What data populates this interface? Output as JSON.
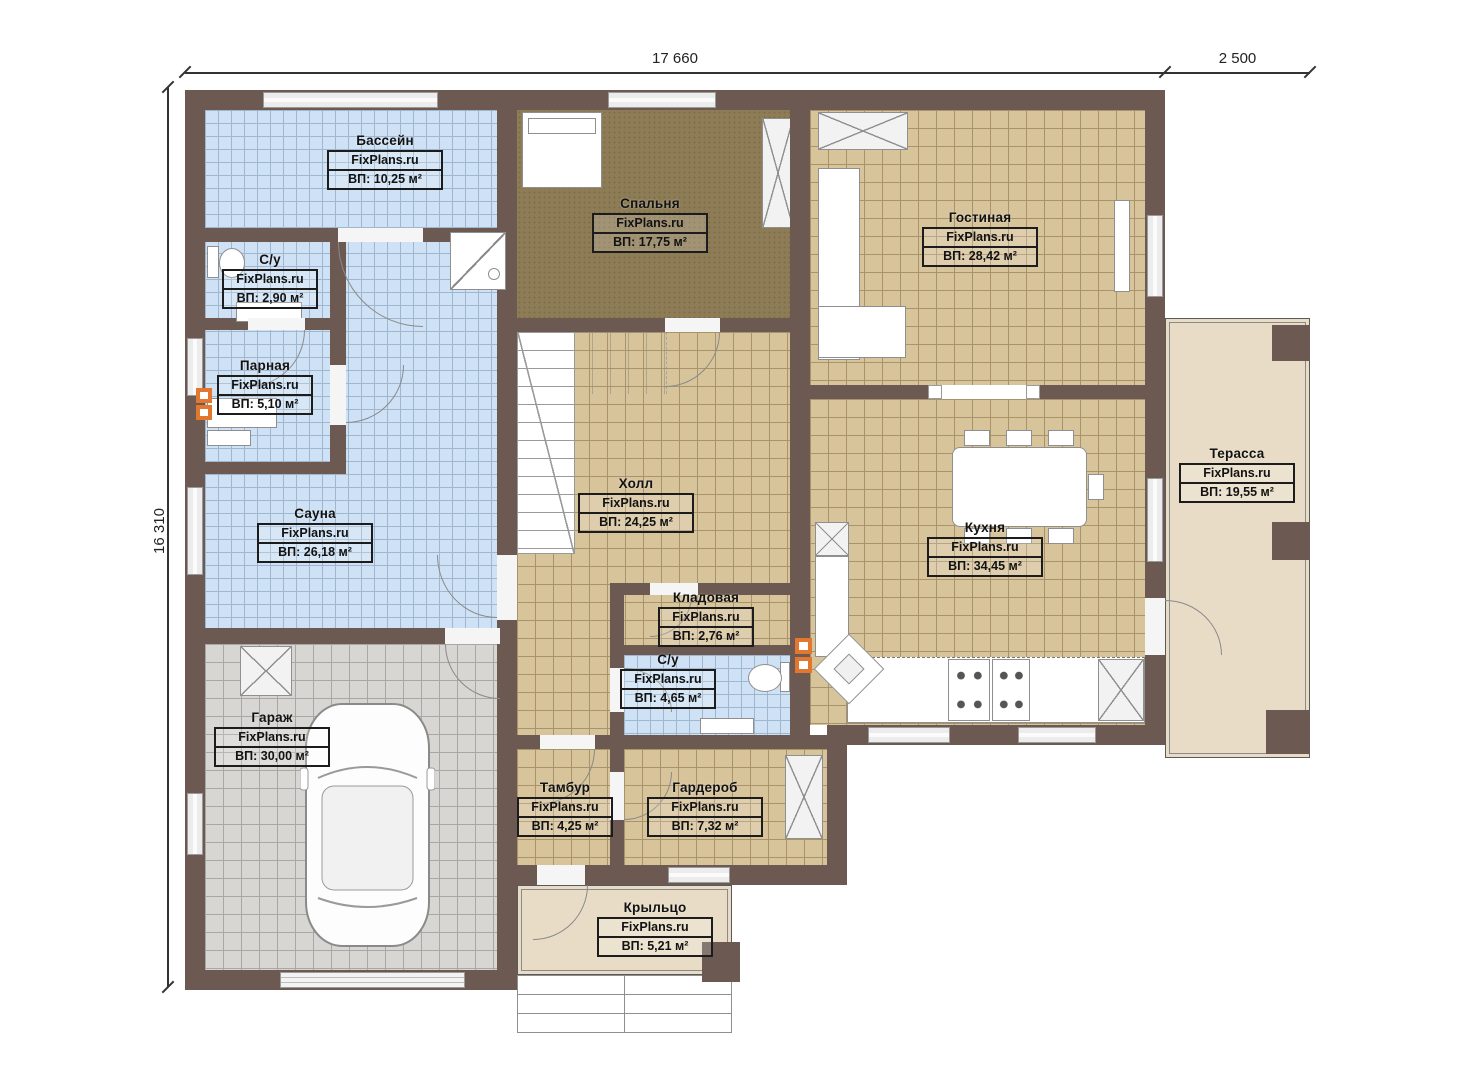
{
  "plan": {
    "brand": "FixPlans.ru",
    "dimensions": {
      "width_main": "17 660",
      "width_terrace": "2 500",
      "height": "16 310"
    }
  },
  "rooms": [
    {
      "name": "Бассейн",
      "area": "ВП: 10,25 м²"
    },
    {
      "name": "С/у",
      "area": "ВП: 2,90 м²"
    },
    {
      "name": "Парная",
      "area": "ВП: 5,10 м²"
    },
    {
      "name": "Сауна",
      "area": "ВП: 26,18 м²"
    },
    {
      "name": "Гараж",
      "area": "ВП: 30,00 м²"
    },
    {
      "name": "Спальня",
      "area": "ВП: 17,75 м²"
    },
    {
      "name": "Холл",
      "area": "ВП: 24,25 м²"
    },
    {
      "name": "Кладовая",
      "area": "ВП: 2,76 м²"
    },
    {
      "name": "С/у",
      "area": "ВП: 4,65 м²"
    },
    {
      "name": "Тамбур",
      "area": "ВП: 4,25 м²"
    },
    {
      "name": "Гардероб",
      "area": "ВП: 7,32 м²"
    },
    {
      "name": "Гостиная",
      "area": "ВП: 28,42 м²"
    },
    {
      "name": "Кухня",
      "area": "ВП: 34,45 м²"
    },
    {
      "name": "Терасса",
      "area": "ВП: 19,55 м²"
    },
    {
      "name": "Крыльцо",
      "area": "ВП: 5,21 м²"
    }
  ],
  "colors": {
    "wall": "#6b5952",
    "tile_blue": "#cfe2f5",
    "tile_tan": "#d8c49b",
    "carpet": "#8d7c55",
    "garage": "#d8d6d2",
    "outdoor": "#e8dcc6",
    "accent": "#e2782f"
  }
}
